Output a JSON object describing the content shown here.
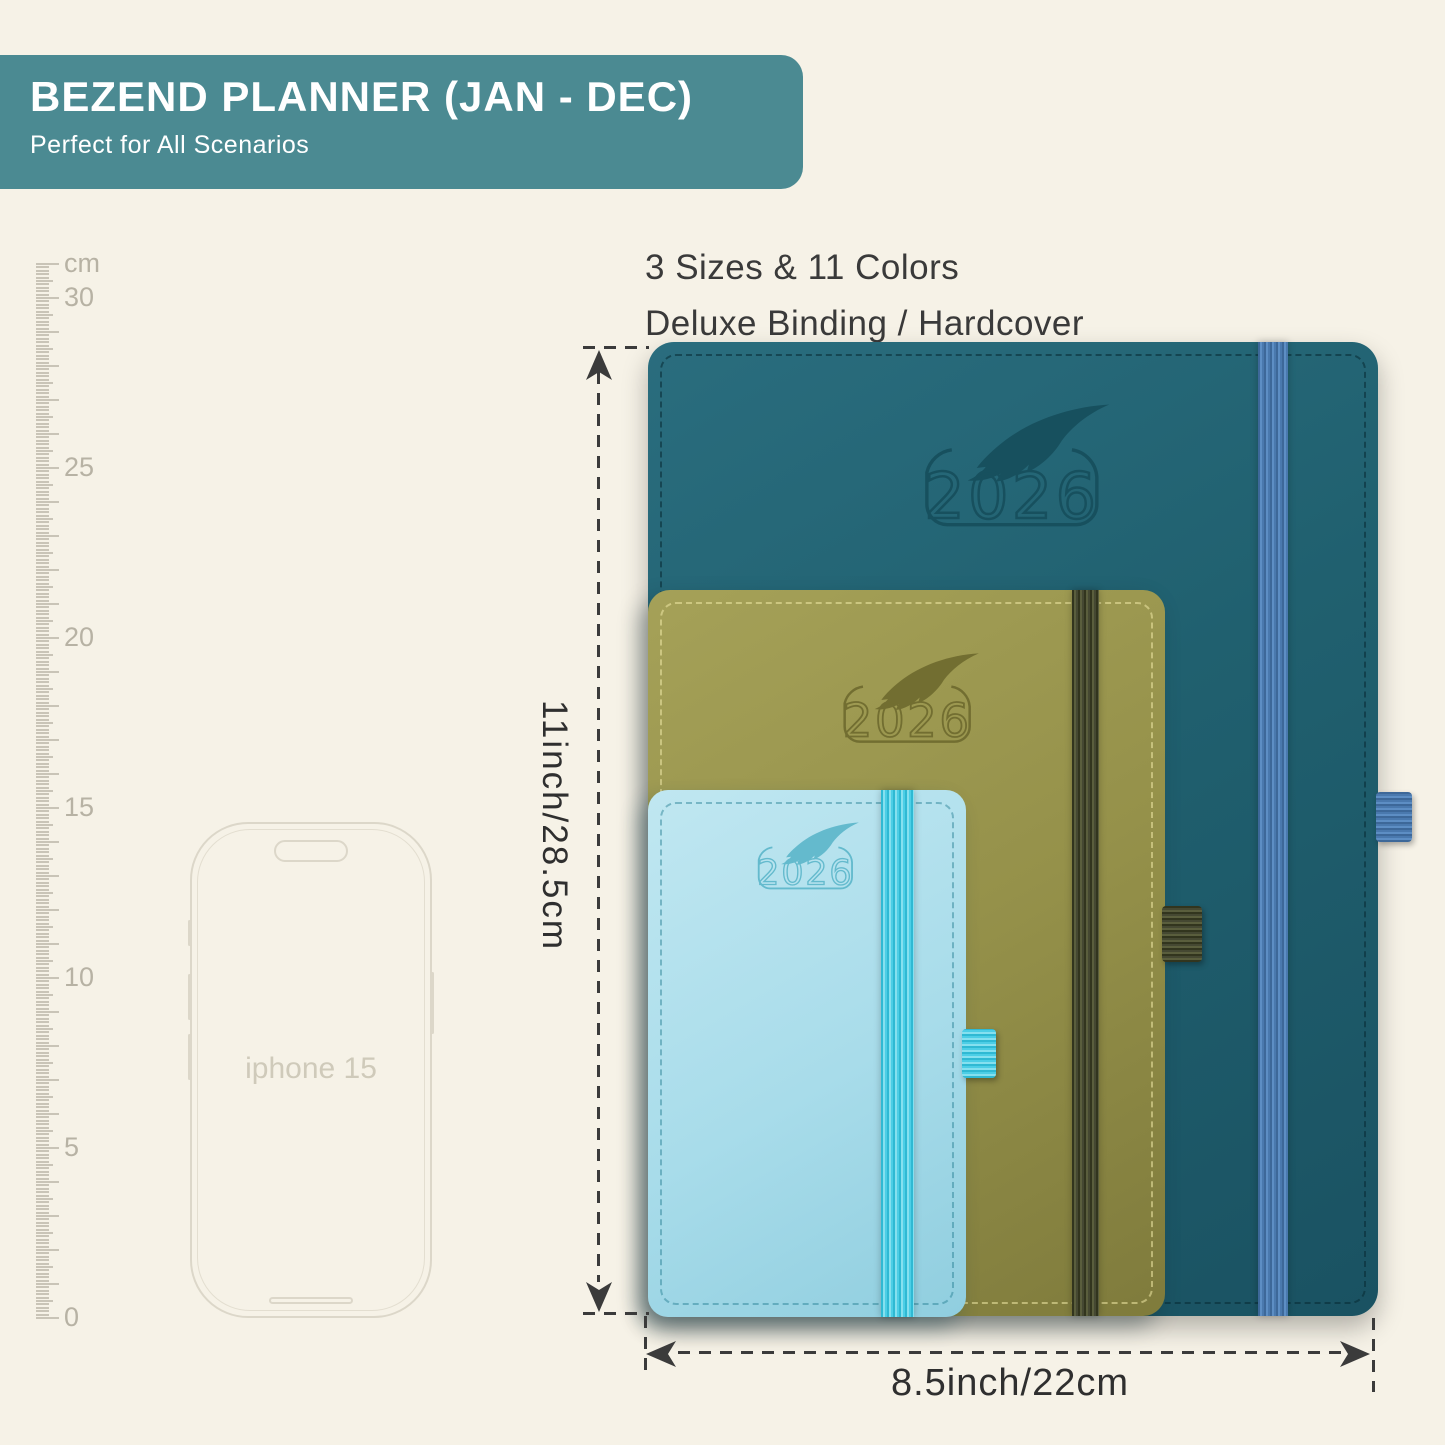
{
  "banner": {
    "title": "BEZEND PLANNER (JAN - DEC)",
    "subtitle": "Perfect for All Scenarios",
    "bg_color": "#4b8a92"
  },
  "features": {
    "line1": "3 Sizes & 11 Colors",
    "line2": "Deluxe Binding / Hardcover"
  },
  "ruler": {
    "unit": "cm",
    "max_cm": 31,
    "labels": [
      30,
      25,
      20,
      15,
      10,
      5,
      0
    ]
  },
  "phone": {
    "label": "iphone 15"
  },
  "planners": [
    {
      "size": "large",
      "year": "2026",
      "cover_color": "#20606f",
      "band_color": "#4a79ae"
    },
    {
      "size": "medium",
      "year": "2026",
      "cover_color": "#95914a",
      "band_color": "#454832"
    },
    {
      "size": "small",
      "year": "2026",
      "cover_color": "#a8dcea",
      "band_color": "#4ccee6"
    }
  ],
  "dimensions": {
    "height_label": "11inch/28.5cm",
    "width_label": "8.5inch/22cm"
  },
  "colors": {
    "background": "#f6f2e7",
    "annotation": "#3b3b3b",
    "ruler_tick": "#c9c4b7",
    "ruler_label": "#b7b2a4",
    "phone_line": "#dcd7c9"
  }
}
